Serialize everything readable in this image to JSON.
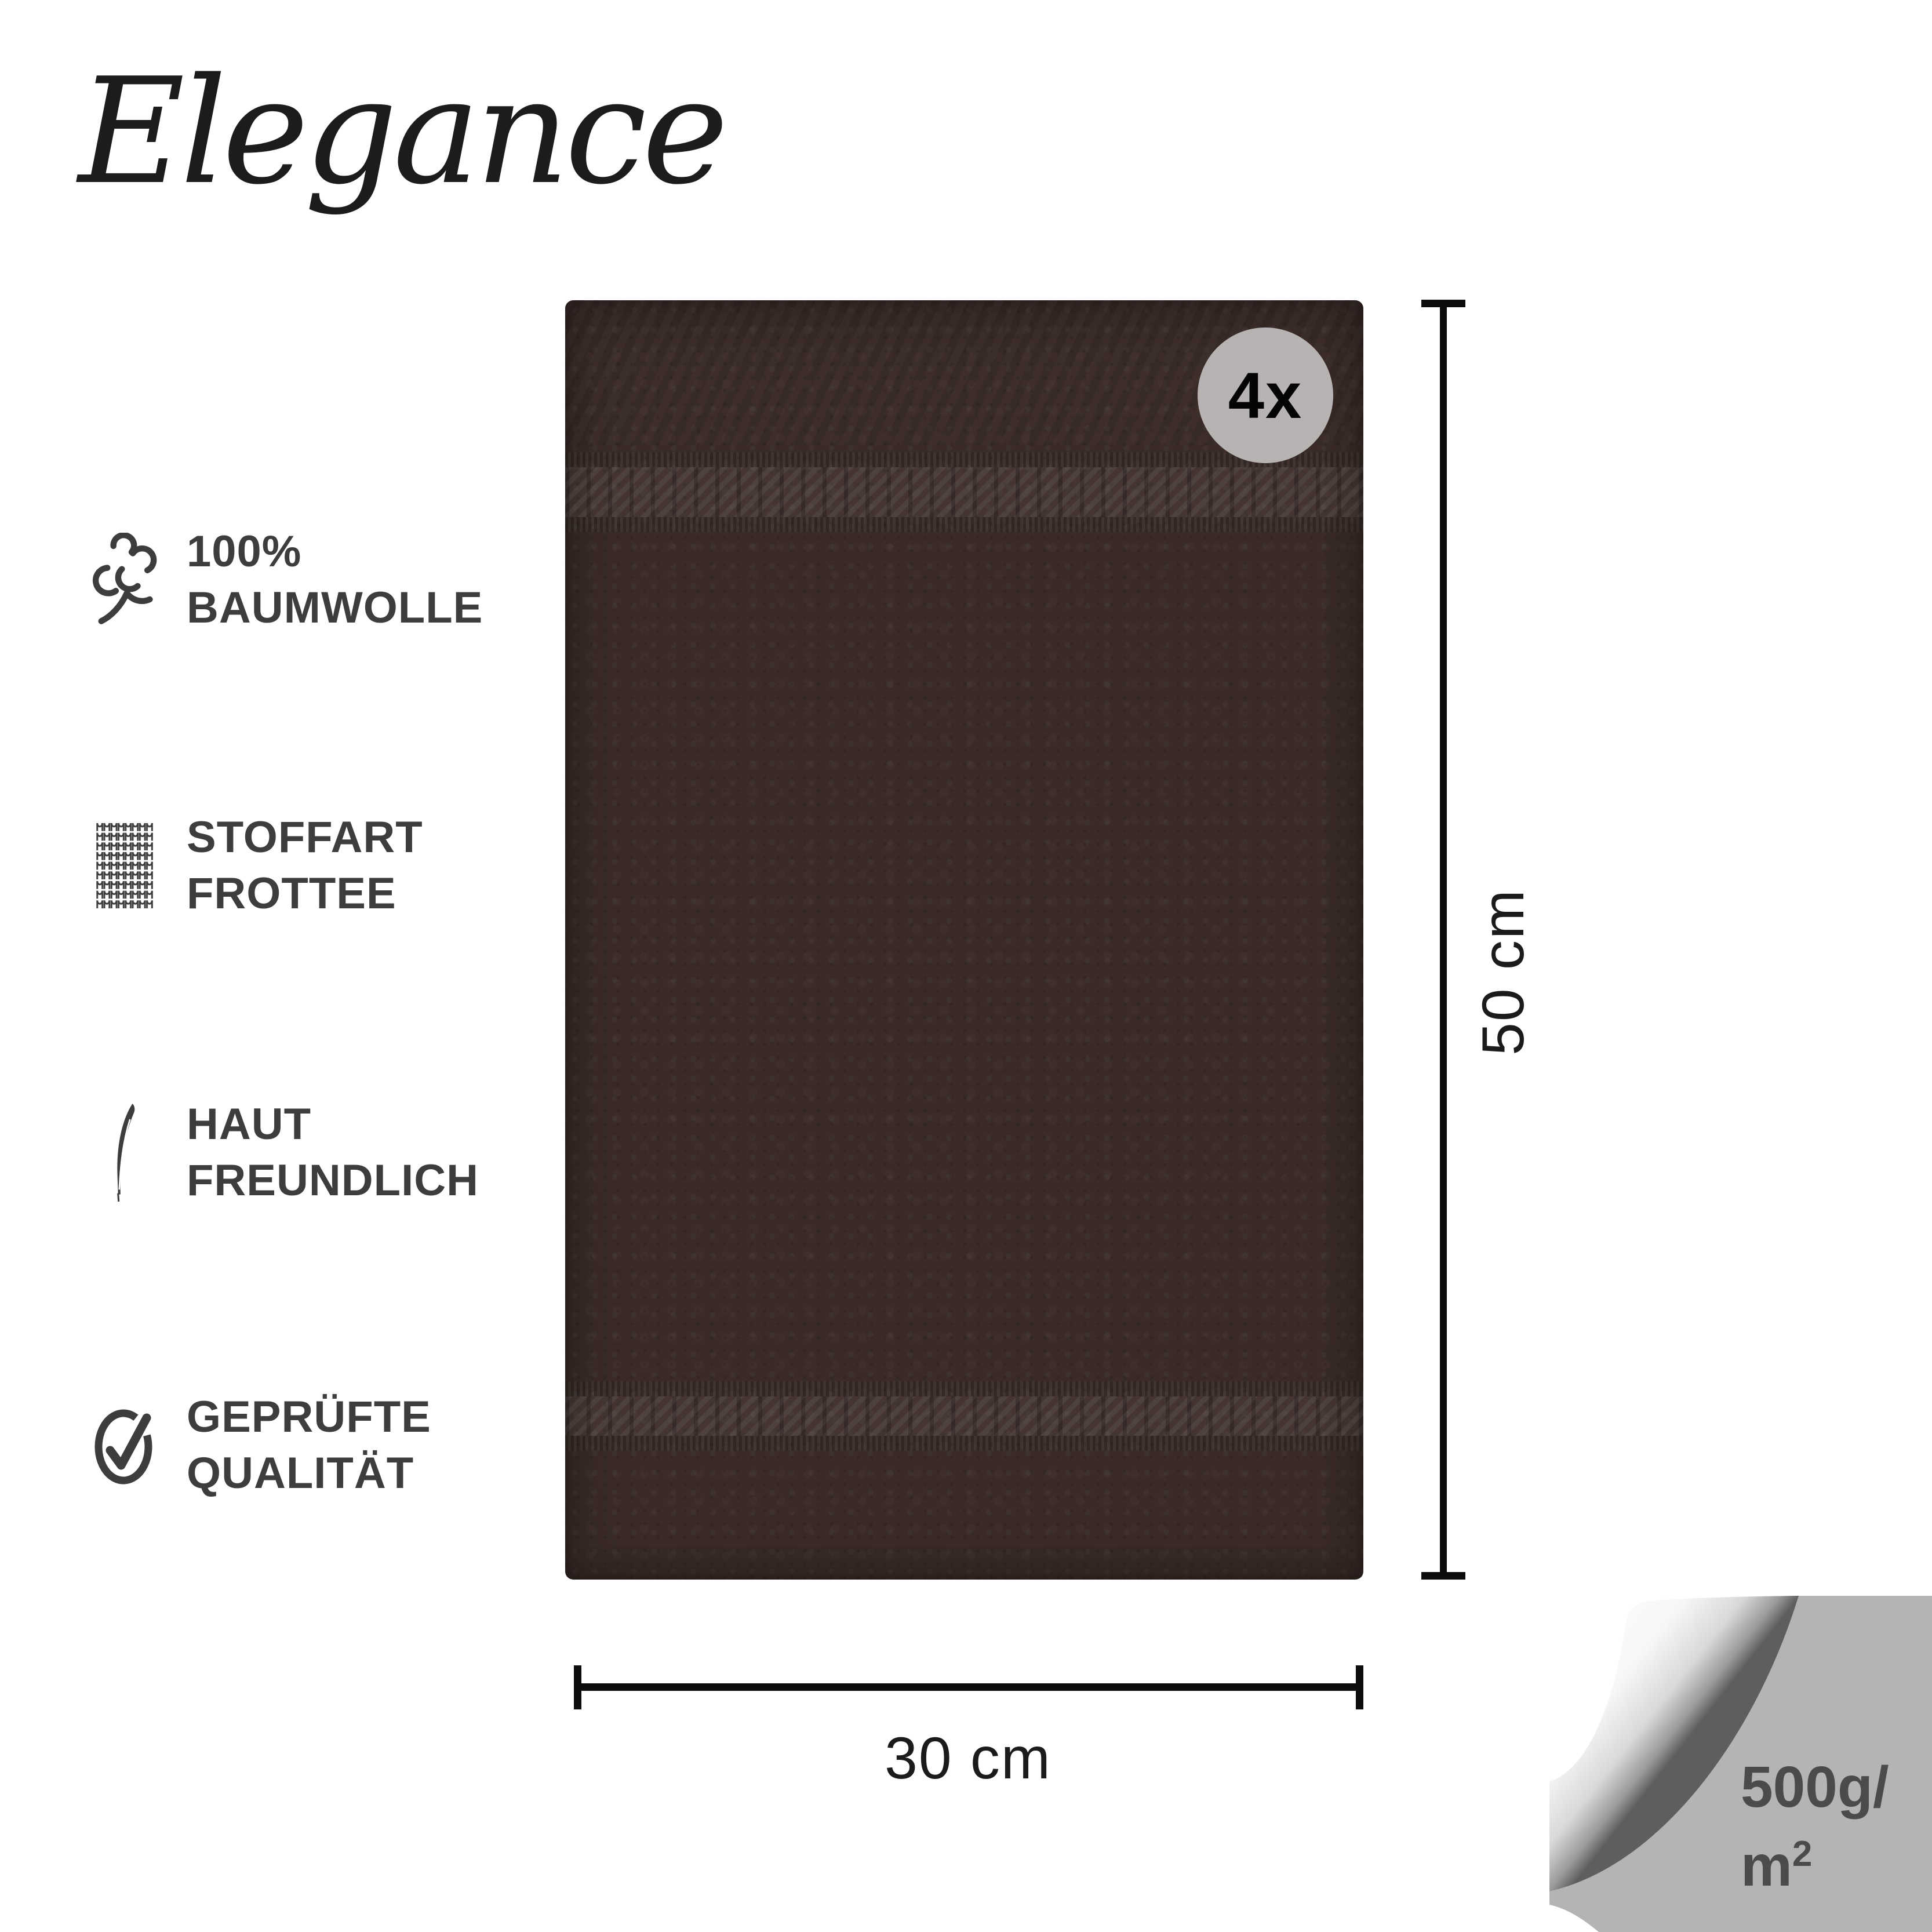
{
  "brand": {
    "logo_text": "Elegance"
  },
  "features": [
    {
      "icon": "cotton-icon",
      "line1": "100%",
      "line2": "BAUMWOLLE"
    },
    {
      "icon": "fabric-knit-icon",
      "line1": "STOFFART",
      "line2": "FROTTEE"
    },
    {
      "icon": "feather-icon",
      "line1": "HAUT",
      "line2": "FREUNDLICH"
    },
    {
      "icon": "check-circle-icon",
      "line1": "GEPRÜFTE",
      "line2": "QUALITÄT"
    }
  ],
  "product": {
    "type": "towel",
    "quantity_badge": "4x",
    "towel_color_hex": "#3a2b27",
    "band_color_hex": "#463430",
    "badge_bg_hex": "#b7b3b2"
  },
  "dimensions": {
    "height_label": "50 cm",
    "width_label": "30 cm"
  },
  "corner_tag": {
    "line1": "500g/",
    "line2_base": "m",
    "line2_sup": "2",
    "bg_hex": "#b4b4b4"
  },
  "colors": {
    "background": "#ffffff",
    "feature_text": "#3d3d3d",
    "dimension_line": "#0d0d0d",
    "dimension_text": "#1b1b1b",
    "corner_text": "#4b4b4b"
  }
}
